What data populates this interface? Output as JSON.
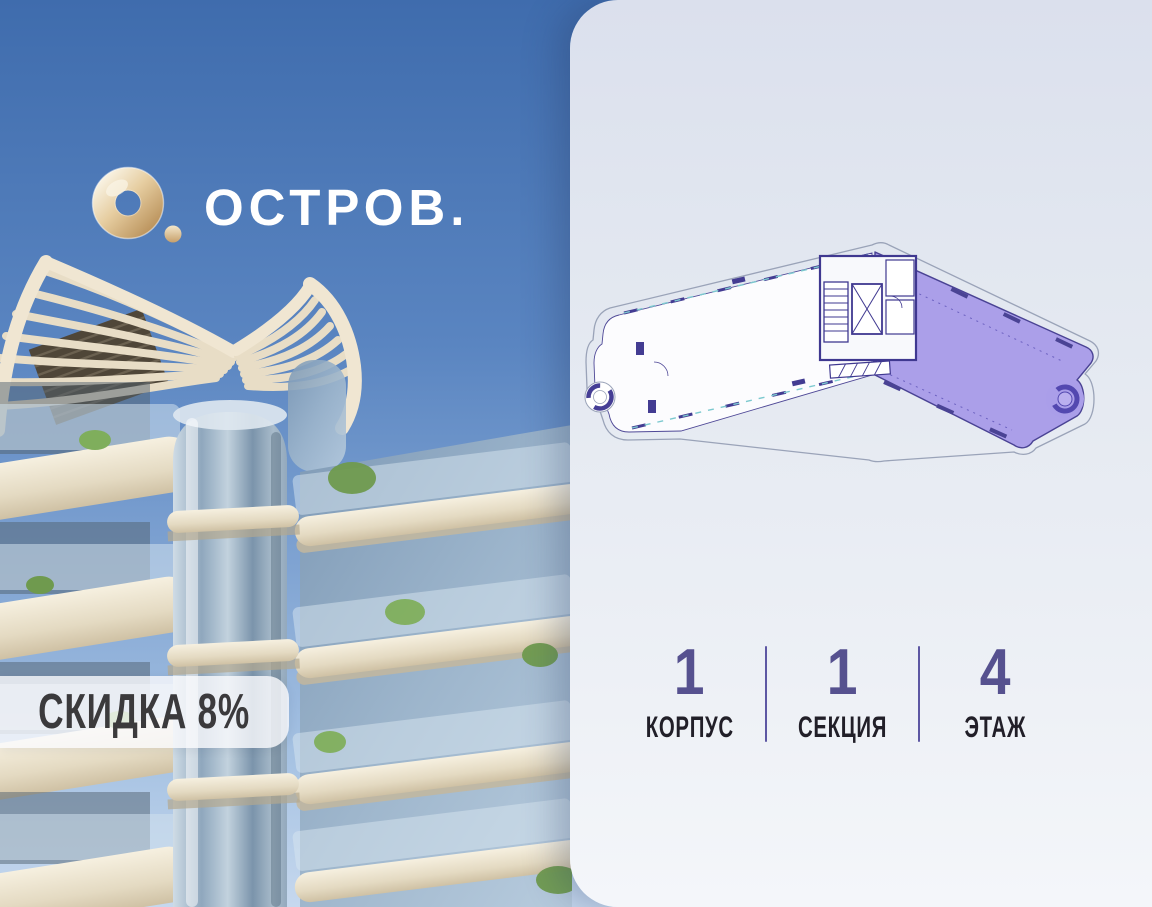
{
  "brand": {
    "name": "ОСТРОВ.",
    "logo_icon": "gold-ring-logo"
  },
  "promo": {
    "discount_label": "СКИДКА 8%"
  },
  "floorplan": {
    "name": "building-floor-plan",
    "highlighted_unit": "right-wing-unit",
    "highlight_color": "#ab9fe9",
    "wall_color": "#4a4394",
    "contour_color": "#9aa3b8"
  },
  "stats": {
    "items": [
      {
        "value": "1",
        "label": "КОРПУС"
      },
      {
        "value": "1",
        "label": "СЕКЦИЯ"
      },
      {
        "value": "4",
        "label": "ЭТАЖ"
      }
    ],
    "value_color": "#56518f",
    "divider_color": "#5d57a3"
  },
  "colors": {
    "sky_top": "#3f6cad",
    "sky_bottom": "#c6d8ee",
    "panel_top": "#dbe0ed",
    "panel_bottom": "#f4f6fa",
    "gold": "#dcc093"
  }
}
